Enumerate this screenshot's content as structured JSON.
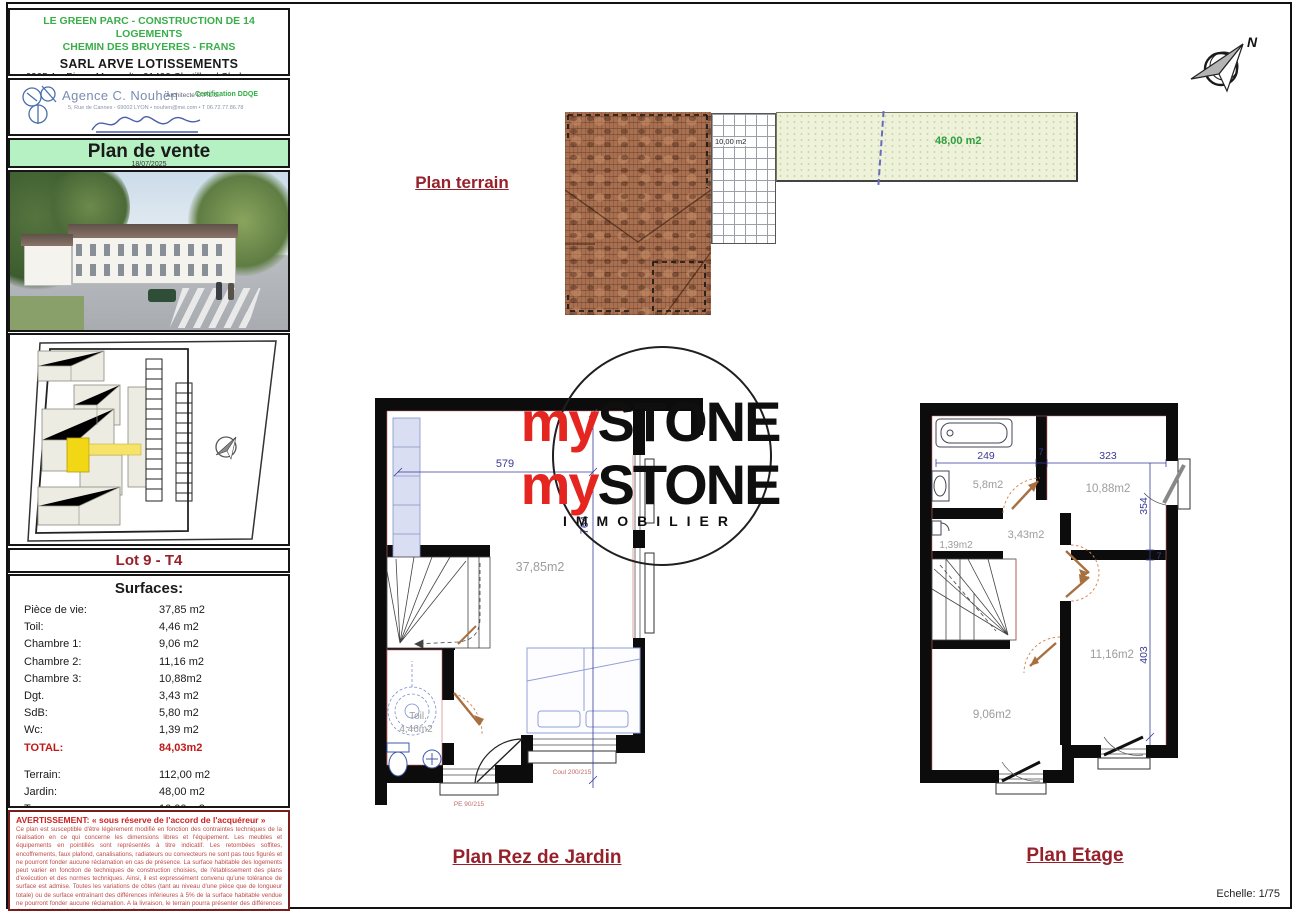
{
  "document": {
    "project_line1": "LE GREEN PARC - CONSTRUCTION DE 14 LOGEMENTS",
    "project_line2": "CHEMIN DES BRUYERES - FRANS",
    "company": "SARL ARVE LOTISSEMENTS",
    "company_address": "6205 Av. Pierre Marcault - 01400 Chatillon / Chalaronne"
  },
  "agency": {
    "name": "Agence C. Nouhën",
    "credentials": "Architecte D.P.L.G.",
    "certification": "Certification DDQE",
    "contact": "5, Rue de Cannes - 69002 LYON • nouhen@me.com • T 06.72.77.86.78"
  },
  "plan_title": {
    "label": "Plan de vente",
    "date": "18/07/2025"
  },
  "lot": {
    "label": "Lot 9 - T4"
  },
  "surfaces": {
    "title": "Surfaces:",
    "rows": [
      {
        "label": "Pièce de vie:",
        "value": "37,85 m2"
      },
      {
        "label": "Toil:",
        "value": "4,46 m2"
      },
      {
        "label": "Chambre 1:",
        "value": "9,06 m2"
      },
      {
        "label": "Chambre 2:",
        "value": "11,16 m2"
      },
      {
        "label": "Chambre 3:",
        "value": "10,88m2"
      },
      {
        "label": "Dgt.",
        "value": "3,43 m2"
      },
      {
        "label": "SdB:",
        "value": "5,80 m2"
      },
      {
        "label": "Wc:",
        "value": "1,39 m2"
      }
    ],
    "total": {
      "label": "TOTAL:",
      "value": "84,03m2"
    },
    "exterior_rows": [
      {
        "label": "Terrain:",
        "value": "112,00 m2"
      },
      {
        "label": "Jardin:",
        "value": "48,00 m2"
      },
      {
        "label": "Terrasse:",
        "value": "10,00 m2"
      }
    ]
  },
  "warning": {
    "title": "AVERTISSEMENT: « sous réserve de l'accord de l'acquéreur »",
    "body": "Ce plan est susceptible d'être légèrement modifié en fonction des contraintes techniques de la réalisation en ce qui concerne les dimensions libres et l'équipement. Les meubles et équipements en pointillés sont représentés à titre indicatif. Les retombées soffites, encoffrements, faux plafond, canalisations, radiateurs ou convecteurs ne sont pas tous figurés et ne pourront fonder aucune réclamation en cas de présence. La surface habitable des logements peut varier en fonction de techniques de construction choisies, de l'établissement des plans d'exécution et des normes techniques. Ainsi, il est expressément convenu qu'une tolérance de surface est admise. Toutes les variations de côtes (tant au niveau d'une pièce que de longueur totale) ou de surface entraînant des différences inférieures à 5% de la surface habitable vendue ne pourront fonder aucune réclamation. A la livraison, le terrain pourra présenter des différences de niveaux dues à la topographie naturelle du lieu, au calage des voiries, et aux contraintes techniques liées à la construction."
  },
  "terrain": {
    "title": "Plan terrain",
    "terrasse_area": "10,00 m2",
    "jardin_area": "48,00 m2"
  },
  "watermark": {
    "brand_prefix": "my",
    "brand_suffix": "STONE",
    "subtitle": "IMMOBILIER"
  },
  "rdj": {
    "title": "Plan Rez de Jardin",
    "dim_width": "579",
    "dim_height": "764",
    "living_area": "37,85m2",
    "toilet_name": "Toil.",
    "toilet_area": "4,46m2",
    "window_label": "PE 90/215",
    "bay_label": "Coul 200/215"
  },
  "etage": {
    "title": "Plan Etage",
    "dims": {
      "d249": "249",
      "d7a": "7",
      "d323": "323",
      "d354": "354",
      "d7b": "7",
      "d403": "403"
    },
    "rooms": {
      "sdb": "5,8m2",
      "ch3": "10,88m2",
      "wc": "1,39m2",
      "dgt": "3,43m2",
      "ch1": "9,06m2",
      "ch2": "11,16m2"
    }
  },
  "footer": {
    "scale": "Echelle: 1/75"
  },
  "compass": {
    "north": "N"
  }
}
